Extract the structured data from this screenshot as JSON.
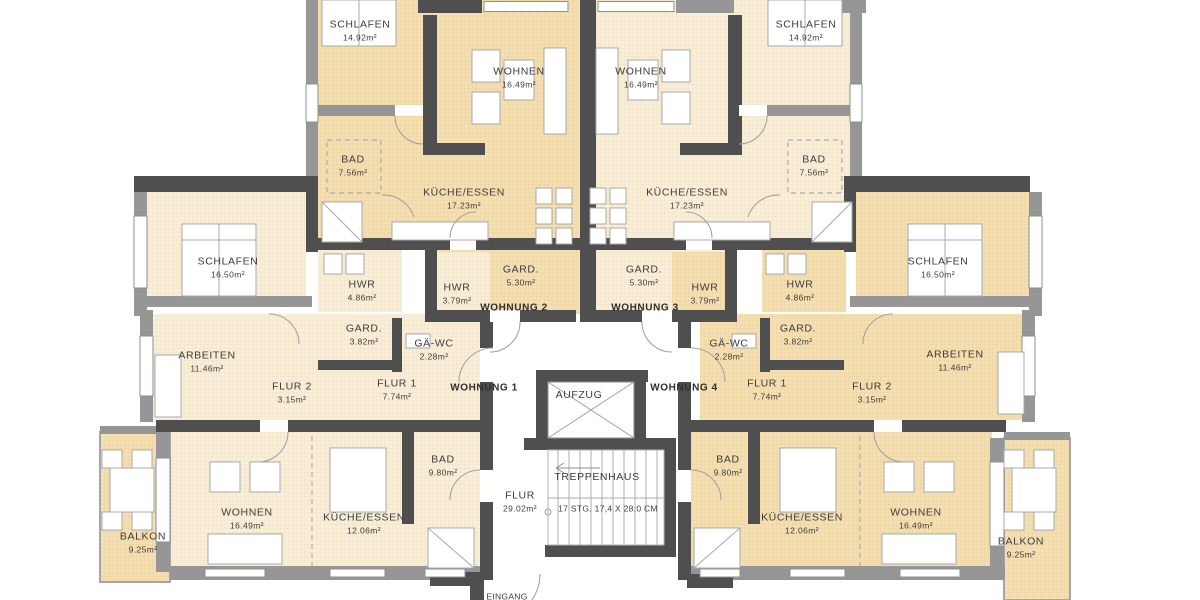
{
  "title": "Grundriss Mehrfamilienhaus - Wohnungen 1-4",
  "colors": {
    "room_light": "#f8eed9",
    "room_light_grid": "#eedfbc",
    "room_dark": "#f4dfb2",
    "room_dark_grid": "#e7cd96",
    "wall_dark": "#4f4f4f",
    "wall_mid": "#969696",
    "line": "#9f9f9f",
    "text": "#3d3d3d"
  },
  "apartments": [
    {
      "id": "wohnung-1",
      "label": "WOHNUNG 1"
    },
    {
      "id": "wohnung-2",
      "label": "WOHNUNG 2"
    },
    {
      "id": "wohnung-3",
      "label": "WOHNUNG 3"
    },
    {
      "id": "wohnung-4",
      "label": "WOHNUNG 4"
    }
  ],
  "core": {
    "elevator": "AUFZUG",
    "stairwell": "TREPPENHAUS",
    "stair_note": "17 STG.  17,4 X 28,0 CM",
    "corridor": "FLUR 29.02m²",
    "entrance": "EINGANG"
  },
  "labels": [
    {
      "id": "schlafen-top-left",
      "name": "SCHLAFEN",
      "area": "14.92m²",
      "x": 360,
      "y": 31
    },
    {
      "id": "wohnen-top-left",
      "name": "WOHNEN",
      "area": "16.49m²",
      "x": 519,
      "y": 78
    },
    {
      "id": "wohnen-top-right",
      "name": "WOHNEN",
      "area": "16.49m²",
      "x": 641,
      "y": 78
    },
    {
      "id": "schlafen-top-right",
      "name": "SCHLAFEN",
      "area": "14.92m²",
      "x": 806,
      "y": 31
    },
    {
      "id": "bad-top-left",
      "name": "BAD",
      "area": "7.56m²",
      "x": 353,
      "y": 166
    },
    {
      "id": "bad-top-right",
      "name": "BAD",
      "area": "7.56m²",
      "x": 814,
      "y": 166
    },
    {
      "id": "kueche-top-left",
      "name": "KÜCHE/ESSEN",
      "area": "17.23m²",
      "x": 464,
      "y": 199
    },
    {
      "id": "kueche-top-right",
      "name": "KÜCHE/ESSEN",
      "area": "17.23m²",
      "x": 687,
      "y": 199
    },
    {
      "id": "schlafen-mid-left",
      "name": "SCHLAFEN",
      "area": "16.50m²",
      "x": 228,
      "y": 268
    },
    {
      "id": "schlafen-mid-right",
      "name": "SCHLAFEN",
      "area": "16.50m²",
      "x": 938,
      "y": 268
    },
    {
      "id": "hwr-left",
      "name": "HWR",
      "area": "4.86m²",
      "x": 362,
      "y": 291
    },
    {
      "id": "hwr-center-left",
      "name": "HWR",
      "area": "3.79m²",
      "x": 457,
      "y": 294
    },
    {
      "id": "gard-center-left",
      "name": "GARD.",
      "area": "5.30m²",
      "x": 521,
      "y": 276
    },
    {
      "id": "gard-center-right",
      "name": "GARD.",
      "area": "5.30m²",
      "x": 644,
      "y": 276
    },
    {
      "id": "hwr-center-right",
      "name": "HWR",
      "area": "3.79m²",
      "x": 705,
      "y": 294
    },
    {
      "id": "hwr-right",
      "name": "HWR",
      "area": "4.86m²",
      "x": 800,
      "y": 291
    },
    {
      "id": "wohnung-2-label",
      "name": "WOHNUNG 2",
      "x": 514,
      "y": 308,
      "bold": true
    },
    {
      "id": "wohnung-3-label",
      "name": "WOHNUNG 3",
      "x": 645,
      "y": 308,
      "bold": true
    },
    {
      "id": "gard-left",
      "name": "GARD.",
      "area": "3.82m²",
      "x": 364,
      "y": 335
    },
    {
      "id": "gae-wc-left",
      "name": "GÄ-WC",
      "area": "2.28m²",
      "x": 434,
      "y": 350
    },
    {
      "id": "gae-wc-right",
      "name": "GÄ-WC",
      "area": "2.28m²",
      "x": 729,
      "y": 350
    },
    {
      "id": "gard-right",
      "name": "GARD.",
      "area": "3.82m²",
      "x": 798,
      "y": 335
    },
    {
      "id": "arbeiten-left",
      "name": "ARBEITEN",
      "area": "11.46m²",
      "x": 207,
      "y": 362
    },
    {
      "id": "arbeiten-right",
      "name": "ARBEITEN",
      "area": "11.46m²",
      "x": 955,
      "y": 361
    },
    {
      "id": "flur2-left",
      "name": "FLUR 2",
      "area": "3.15m²",
      "x": 292,
      "y": 393
    },
    {
      "id": "flur1-left",
      "name": "FLUR 1",
      "area": "7.74m²",
      "x": 397,
      "y": 390
    },
    {
      "id": "wohnung-1-label",
      "name": "WOHNUNG 1",
      "x": 484,
      "y": 388,
      "bold": true
    },
    {
      "id": "wohnung-4-label",
      "name": "WOHNUNG 4",
      "x": 684,
      "y": 388,
      "bold": true
    },
    {
      "id": "flur1-right",
      "name": "FLUR 1",
      "area": "7.74m²",
      "x": 767,
      "y": 390
    },
    {
      "id": "flur2-right",
      "name": "FLUR 2",
      "area": "3.15m²",
      "x": 872,
      "y": 393
    },
    {
      "id": "aufzug-label",
      "name": "AUFZUG",
      "x": 579,
      "y": 396
    },
    {
      "id": "bad-bottom-left",
      "name": "BAD",
      "area": "9.80m²",
      "x": 443,
      "y": 466
    },
    {
      "id": "bad-bottom-right",
      "name": "BAD",
      "area": "9.80m²",
      "x": 728,
      "y": 466
    },
    {
      "id": "treppenhaus-label",
      "name": "TREPPENHAUS",
      "x": 597,
      "y": 478
    },
    {
      "id": "flur-center",
      "name": "FLUR",
      "area": "29.02m²",
      "x": 520,
      "y": 502
    },
    {
      "id": "stair-note",
      "name": "17 STG.  17,4 X 28,0 CM",
      "x": 608,
      "y": 509,
      "note": true
    },
    {
      "id": "wohnen-bottom-left",
      "name": "WOHNEN",
      "area": "16.49m²",
      "x": 247,
      "y": 519
    },
    {
      "id": "kueche-bottom-left",
      "name": "KÜCHE/ESSEN",
      "area": "12.06m²",
      "x": 364,
      "y": 524
    },
    {
      "id": "kueche-bottom-right",
      "name": "KÜCHE/ESSEN",
      "area": "12.06m²",
      "x": 802,
      "y": 524
    },
    {
      "id": "wohnen-bottom-right",
      "name": "WOHNEN",
      "area": "16.49m²",
      "x": 916,
      "y": 519
    },
    {
      "id": "balkon-bottom-left",
      "name": "BALKON",
      "area": "9.25m²",
      "x": 143,
      "y": 543
    },
    {
      "id": "balkon-bottom-right",
      "name": "BALKON",
      "area": "9.25m²",
      "x": 1021,
      "y": 548
    },
    {
      "id": "eingang-label",
      "name": "EINGANG",
      "x": 507,
      "y": 597,
      "note": true
    }
  ]
}
